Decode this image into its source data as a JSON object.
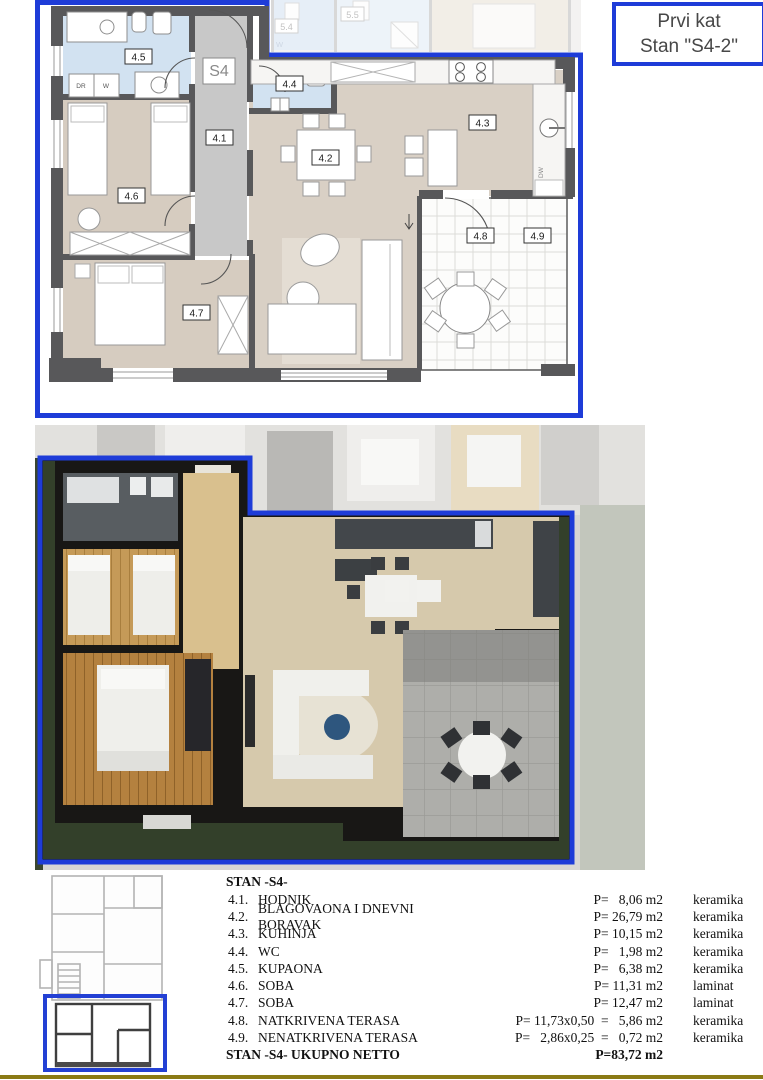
{
  "header": {
    "line1": "Prvi kat",
    "line2": "Stan \"S4-2\""
  },
  "plan2d": {
    "unit_label": "S4",
    "room_labels": {
      "r41": "4.1",
      "r42": "4.2",
      "r43": "4.3",
      "r44": "4.4",
      "r45": "4.5",
      "r46": "4.6",
      "r47": "4.7",
      "r48": "4.8",
      "r49": "4.9"
    },
    "fixture_labels": {
      "dr": "DR",
      "w": "W",
      "dw": "DW"
    },
    "adjacent_labels": {
      "r54": "5.4",
      "r55": "5.5",
      "w": "W"
    }
  },
  "table": {
    "title": "STAN -S4-",
    "rows": [
      {
        "num": "4.1.",
        "name": "HODNIK",
        "value": "P=   8,06 m2",
        "material": "keramika"
      },
      {
        "num": "4.2.",
        "name": "BLAGOVAONA I DNEVNI BORAVAK",
        "value": "P= 26,79 m2",
        "material": "keramika"
      },
      {
        "num": "4.3.",
        "name": "KUHINJA",
        "value": "P= 10,15 m2",
        "material": "keramika"
      },
      {
        "num": "4.4.",
        "name": "WC",
        "value": "P=   1,98 m2",
        "material": "keramika"
      },
      {
        "num": "4.5.",
        "name": "KUPAONA",
        "value": "P=   6,38 m2",
        "material": "keramika"
      },
      {
        "num": "4.6.",
        "name": "SOBA",
        "value": "P= 11,31 m2",
        "material": "laminat"
      },
      {
        "num": "4.7.",
        "name": "SOBA",
        "value": "P= 12,47 m2",
        "material": "laminat"
      },
      {
        "num": "4.8.",
        "name": "NATKRIVENA TERASA",
        "value": "P= 11,73x0,50  =   5,86 m2",
        "material": "keramika"
      },
      {
        "num": "4.9.",
        "name": "NENATKRIVENA TERASA",
        "value": "P=   2,86x0,25  =   0,72 m2",
        "material": "keramika"
      }
    ],
    "total_label": "STAN -S4- UKUPNO NETTO",
    "total_value": "P=83,72 m2"
  },
  "colors": {
    "accent_blue": "#1e3cd8",
    "divider_olive": "#8a7a15"
  }
}
